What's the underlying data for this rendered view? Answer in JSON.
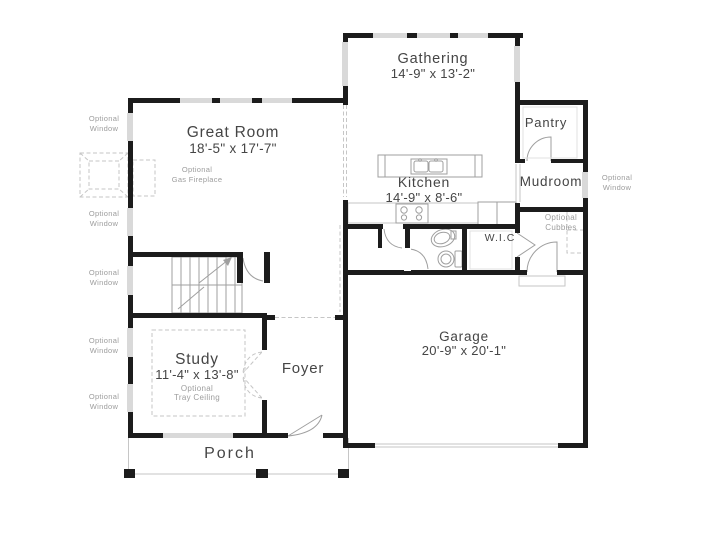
{
  "plan": {
    "rooms": {
      "gathering": {
        "name": "Gathering",
        "dims": "14'-9\" x 13'-2\""
      },
      "great_room": {
        "name": "Great Room",
        "dims": "18'-5\" x 17'-7\""
      },
      "kitchen": {
        "name": "Kitchen",
        "dims": "14'-9\" x 8'-6\""
      },
      "pantry": {
        "name": "Pantry"
      },
      "mudroom": {
        "name": "Mudroom"
      },
      "wic": {
        "name": "W.I.C"
      },
      "garage": {
        "name": "Garage",
        "dims": "20'-9\" x 20'-1\""
      },
      "study": {
        "name": "Study",
        "dims": "11'-4\" x 13'-8\"",
        "note": "Optional\nTray Ceiling"
      },
      "foyer": {
        "name": "Foyer"
      },
      "porch": {
        "name": "Porch"
      }
    },
    "annotations": {
      "optional_window": "Optional\nWindow",
      "optional_gas_fireplace": "Optional\nGas Fireplace",
      "optional_cubbies": "Optional\nCubbies"
    },
    "colors": {
      "wall": "#1c1c1c",
      "line": "#9f9f9f",
      "dashed": "#c6c6c6",
      "window": "#d9d9d9",
      "label": "#454545",
      "muted": "#9d9d9d"
    }
  }
}
